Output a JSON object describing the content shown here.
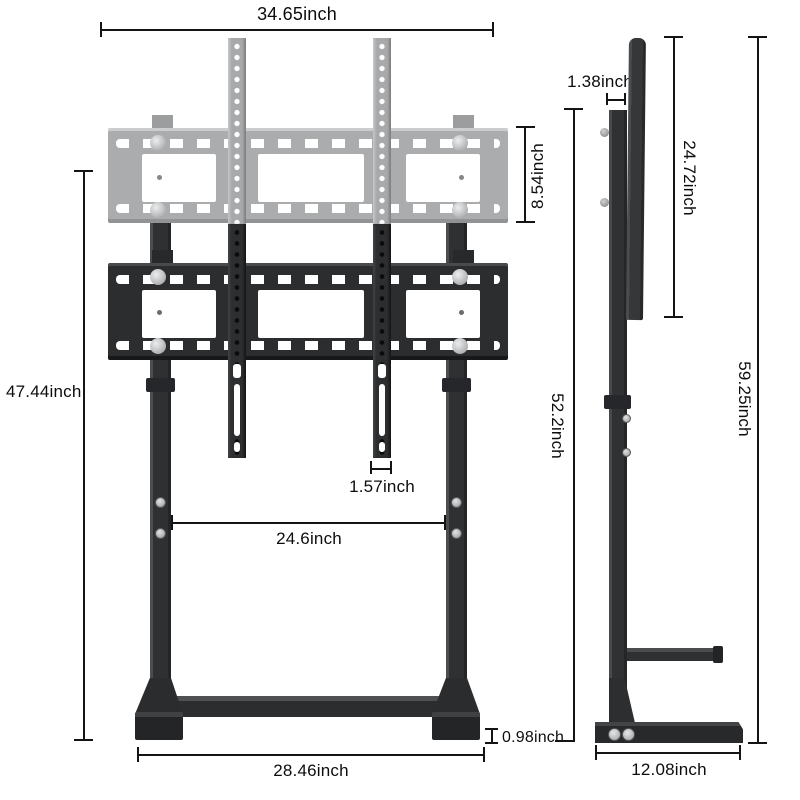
{
  "front_view": {
    "top_width": "34.65inch",
    "bracket_height": "8.54inch",
    "height": "47.44inch",
    "strip_width": "1.57inch",
    "leg_spacing": "24.6inch",
    "foot_height": "0.98inch",
    "base_width": "28.46inch"
  },
  "side_view": {
    "bracket_depth": "1.38inch",
    "plate_height": "24.72inch",
    "column_height": "52.2inch",
    "total_height": "59.25inch",
    "base_depth": "12.08inch"
  },
  "colors": {
    "background": "#ffffff",
    "metal_dark": "#2b2d2f",
    "metal_ghost": "#aaacae",
    "hardware_silver": "#c6c8ca",
    "dimension_line": "#141414"
  }
}
